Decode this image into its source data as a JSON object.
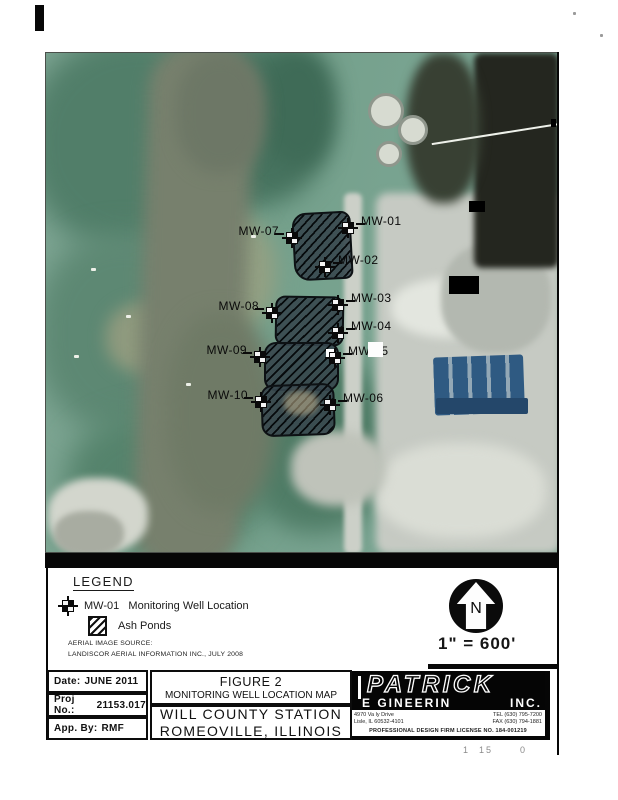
{
  "document": {
    "legend": {
      "title": "LEGEND",
      "well_symbol_label": "MW-01",
      "well_text": "Monitoring Well Location",
      "ash_text": "Ash Ponds",
      "source_line1": "AERIAL IMAGE SOURCE:",
      "source_line2": "LANDISCOR AERIAL INFORMATION INC., JULY 2008"
    },
    "north_label": "N",
    "scale_text": "1\" = 600'",
    "wells": [
      {
        "label": "MW-01"
      },
      {
        "label": "MW-02"
      },
      {
        "label": "MW-03"
      },
      {
        "label": "MW-04"
      },
      {
        "label": "MW-05"
      },
      {
        "label": "MW-06"
      },
      {
        "label": "MW-07"
      },
      {
        "label": "MW-08"
      },
      {
        "label": "MW-09"
      },
      {
        "label": "MW-10"
      }
    ],
    "titleblock": {
      "date_label": "Date:",
      "date_value": "JUNE 2011",
      "proj_label": "Proj No.:",
      "proj_value": "21153.017",
      "app_label": "App. By:",
      "app_value": "RMF",
      "figure_no": "FIGURE 2",
      "figure_title": "MONITORING WELL LOCATION MAP",
      "station_line1": "WILL COUNTY STATION",
      "station_line2": "ROMEOVILLE, ILLINOIS"
    },
    "firm": {
      "name": "PATRICK",
      "name2": "E GINEERIN",
      "name3": "INC.",
      "addr1": "4970 Va ly Drive",
      "addr2": "Lisle, IL 60532-4101",
      "tel": "TEL (630) 795-7200",
      "fax": "FAX (630) 794-1881",
      "license": "PROFESSIONAL DESIGN FIRM   LICENSE NO. 184-001219"
    },
    "stamp": "1  15      0"
  },
  "colors": {
    "pond_fill": "#24323a",
    "photo_green": "#7aa18e",
    "river_olive": "#77806d",
    "industrial_gray": "#c6cac3",
    "coal_dark": "#24261f",
    "plant_blue": "#2f5a82",
    "ink": "#0b0b0b"
  }
}
